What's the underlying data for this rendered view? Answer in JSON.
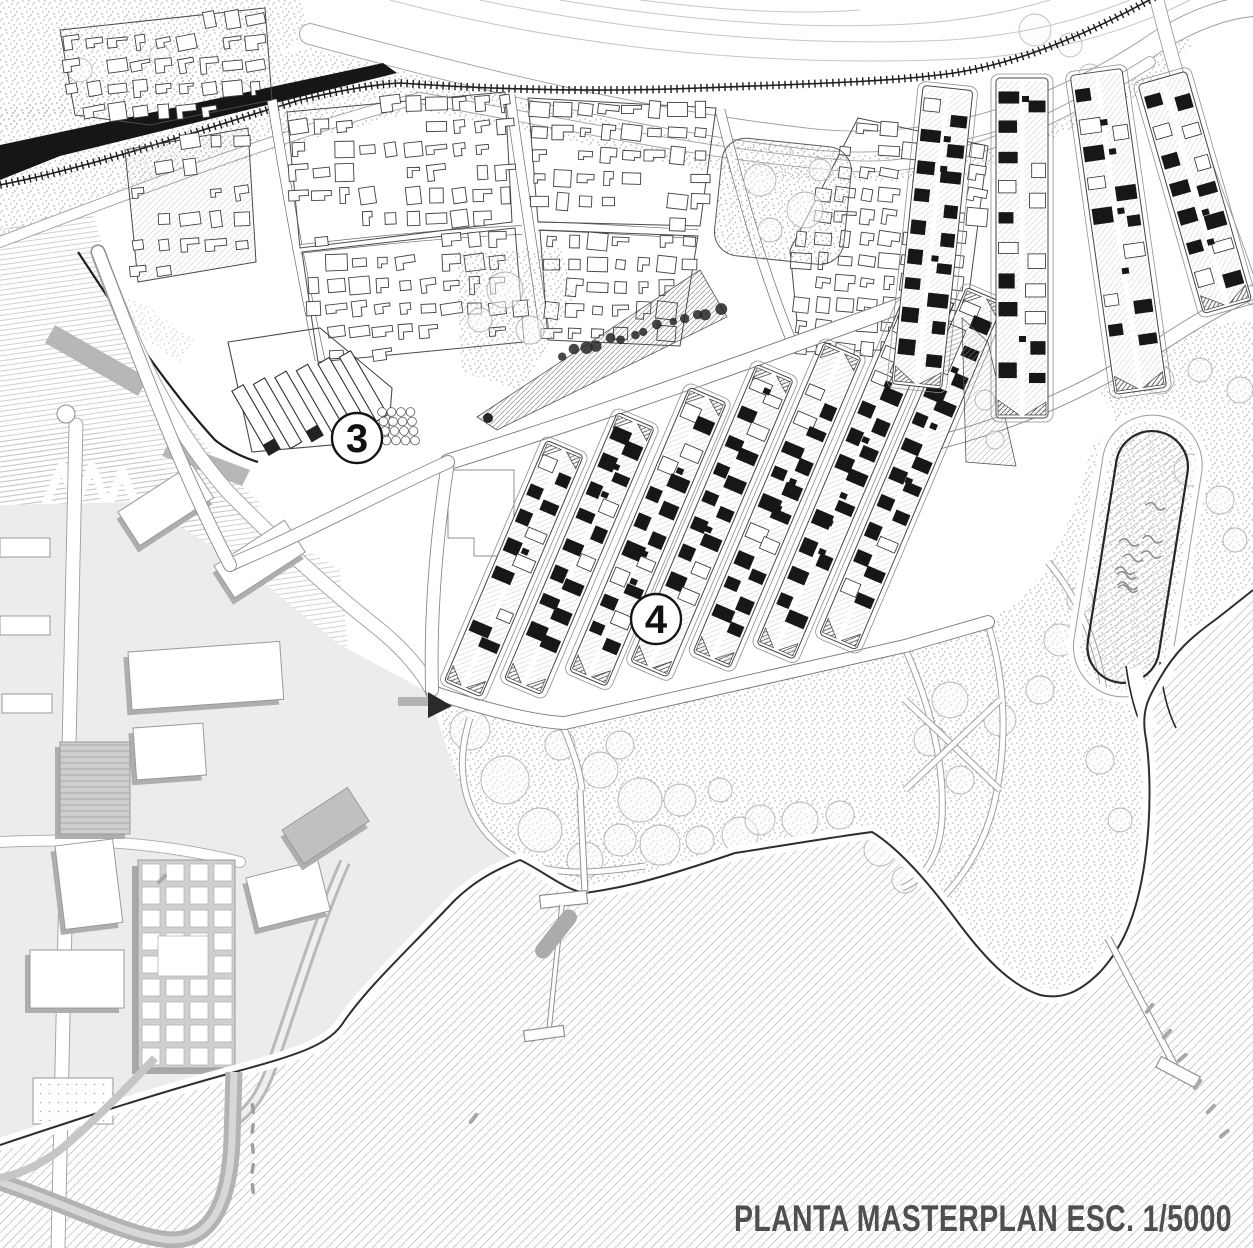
{
  "title": {
    "text": "PLANTA MASTERPLAN ESC. 1/5000"
  },
  "markers": [
    {
      "label": "3",
      "x": 357,
      "y": 438
    },
    {
      "label": "4",
      "x": 656,
      "y": 619
    }
  ],
  "palette": {
    "paper": "#ffffff",
    "ink": "#2b2b2b",
    "sea_hatch_line": "#c3c3c3",
    "stipple_dot": "#9b9b9b",
    "building_dark": "#171717",
    "building_outline": "#3f3f3f",
    "campus_gray": "#d7d7d7",
    "shadow_gray": "#aeaeae",
    "road_edge": "#8a8a8a",
    "railway": "#1d1d1d",
    "title_color": "#4f4f4f"
  }
}
